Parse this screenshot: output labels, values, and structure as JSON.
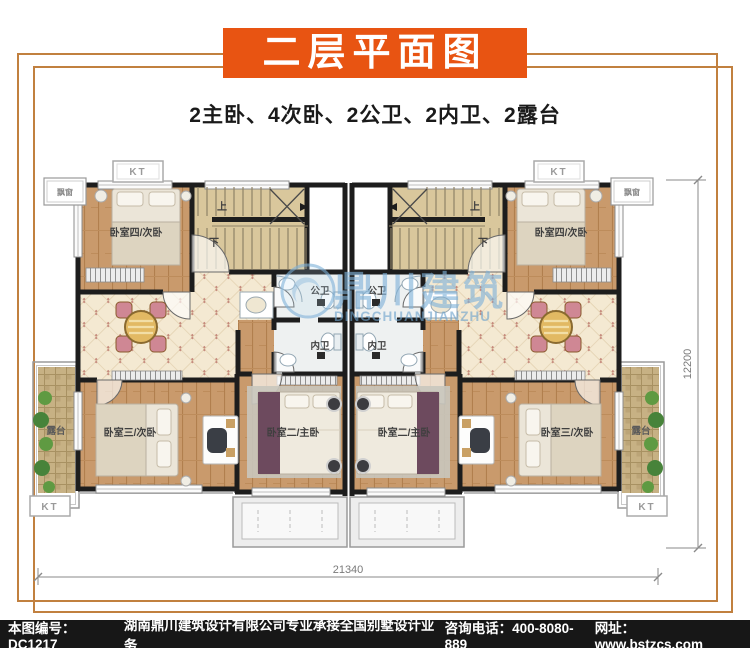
{
  "header": {
    "title": "二层平面图",
    "subtitle": "2主卧、4次卧、2公卫、2内卫、2露台"
  },
  "watermark": {
    "name_cn": "鼎川建筑",
    "name_en": "DINGCHUANJIANZHU"
  },
  "plan": {
    "labels": {
      "bedroom4": "卧室四/次卧",
      "bedroom3": "卧室三/次卧",
      "master": "卧室二/主卧",
      "public_bath": "公卫",
      "ensuite_bath": "内卫",
      "terrace": "露台",
      "stair_up": "上",
      "stair_down": "下",
      "ac_platform": "KT",
      "bay_window": "飘窗"
    },
    "dimensions": {
      "overall_width": "21340",
      "overall_depth": "12200"
    }
  },
  "footer": {
    "drawing_no": "本图编号：DC1217",
    "company": "湖南鼎川建筑设计有限公司专业承接全国别墅设计业务",
    "phone": "咨询电话：400-8080-889",
    "website": "网址：www.bstzcs.com"
  },
  "colors": {
    "banner": "#E85412",
    "frame": "#C1803F",
    "footer_bg": "#171717",
    "wall": "#1D1D1D",
    "wood_floor": "#C99A6C",
    "hall_tile": "#F4E9D2",
    "stair": "#D9C79C",
    "terrace_mosaic": "#C7B184",
    "watermark_blue": "#7FB2D9"
  }
}
